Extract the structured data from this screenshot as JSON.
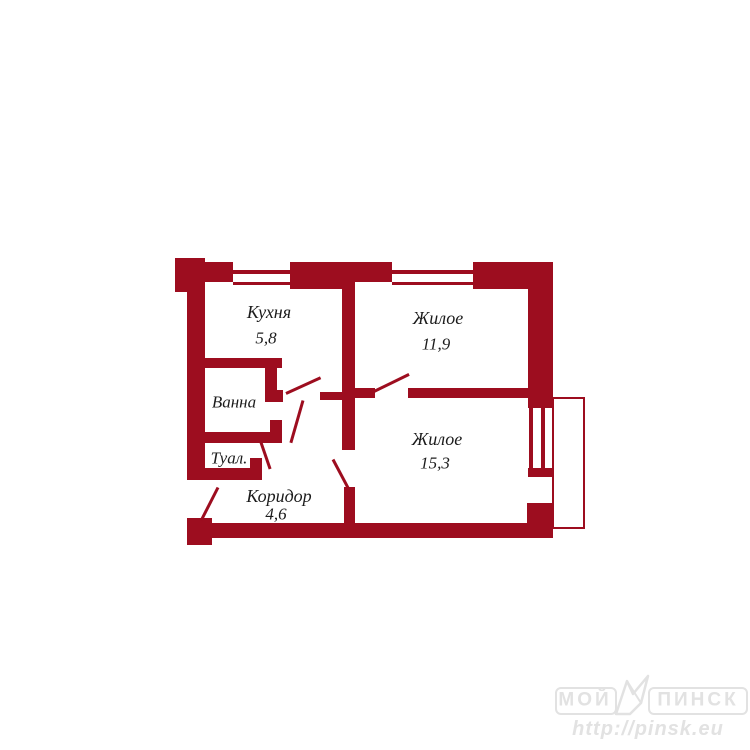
{
  "canvas": {
    "background": "#ffffff"
  },
  "floorplan": {
    "wall_color": "#9d0d1f",
    "label_color": "#1c1c1c",
    "rooms": [
      {
        "name": "Кухня",
        "area": "5,8"
      },
      {
        "name": "Жилое",
        "area": "11,9"
      },
      {
        "name": "Жилое",
        "area": "15,3"
      },
      {
        "name": "Ванна",
        "area": ""
      },
      {
        "name": "Туал.",
        "area": ""
      },
      {
        "name": "Коридор",
        "area": "4,6"
      }
    ],
    "features": {
      "windows": 3,
      "doors": 6,
      "balcony": "balcony-outline-right"
    }
  },
  "watermark": {
    "color": "#e2e2e2",
    "title_left": "МОЙ",
    "title_right": "ПИНСК",
    "url": "http://pinsk.eu"
  }
}
